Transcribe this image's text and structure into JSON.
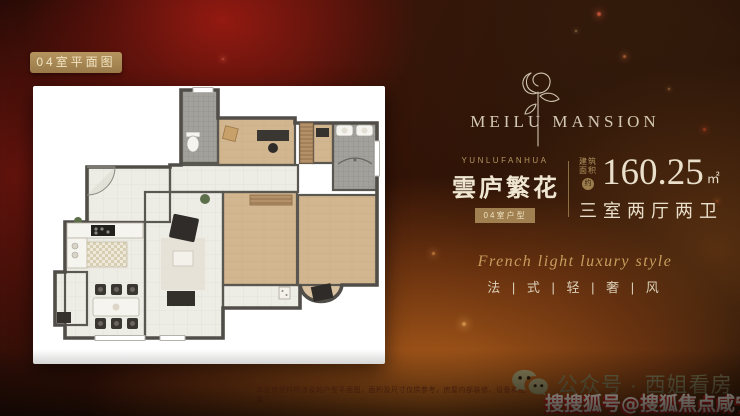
{
  "overlay_badge": {
    "label": "04室平面图"
  },
  "brand": {
    "name": "MEILU MANSION",
    "icon": "rose-line-art"
  },
  "listing": {
    "name_en": "YUNLUFANHUA",
    "name_cn": "雲庐繁花",
    "unit_badge": "04室户型",
    "area_label_line1": "建筑",
    "area_label_line2": "面积",
    "area_prefix": "约",
    "area_value": "160.25",
    "area_unit": "㎡",
    "rooms": "三室两厅两卫"
  },
  "tagline": {
    "en": "French light luxury style",
    "cn": "法 | 式 | 轻 | 奢 | 风"
  },
  "footer": {
    "disclaimer": "本宣传资料所涉及的户型平面图，面积及尺寸仅供参考，房屋内部装修、设备和配置",
    "wechat_label": "公众号 · 西姐看房",
    "watermark": "搜搜狐号@搜狐焦点咸宁站"
  },
  "colors": {
    "badge_gold": "#a8895a",
    "accent_gold": "#b3945f",
    "cream_text": "#e9dfca",
    "wechat_olive": "#6e6a4b",
    "watermark_red": "#bf1f1c",
    "background_red": "#3c1308",
    "background_orange": "#cd7020",
    "floorplan_wall": "#5a5751",
    "floorplan_wood": "#d2b68f",
    "floorplan_tile": "#ecebe4"
  }
}
